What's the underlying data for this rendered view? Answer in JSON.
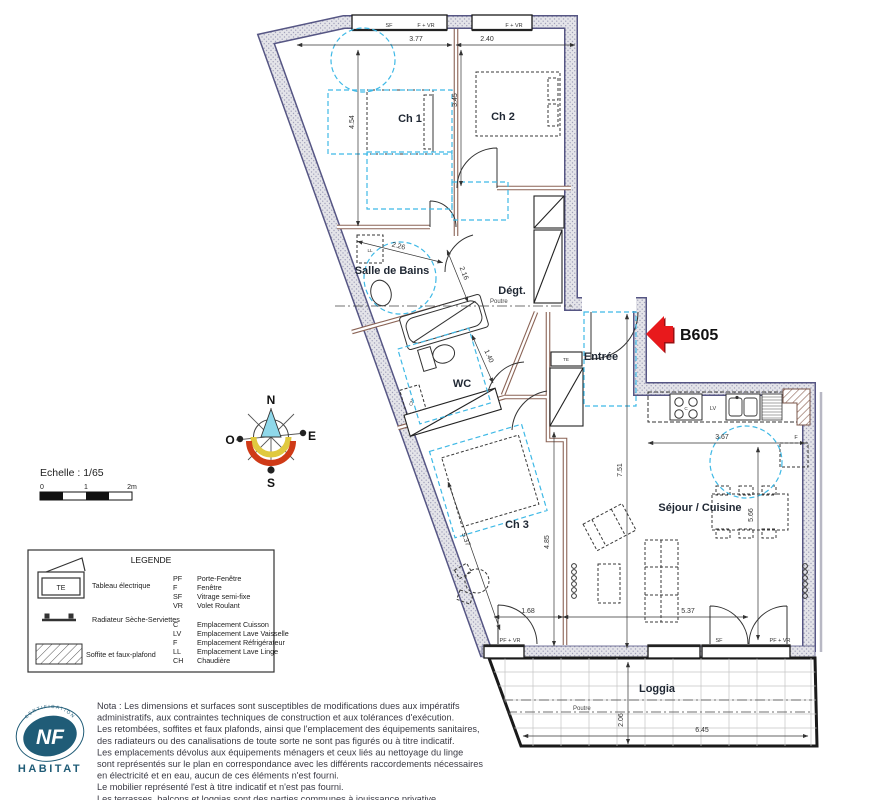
{
  "plan": {
    "unit_label": "B605",
    "rooms": {
      "ch1": "Ch 1",
      "ch2": "Ch 2",
      "ch3": "Ch 3",
      "sdb": "Salle de Bains",
      "degt": "Dégt.",
      "wc": "WC",
      "entree": "Entrée",
      "sejour": "Séjour / Cuisine",
      "loggia": "Loggia"
    },
    "dims": {
      "d377": "3.77",
      "d240": "2.40",
      "d454": "4.54",
      "d345": "3.45",
      "d226": "2.26",
      "d216": "2.16",
      "d140": "1.40",
      "d751": "7.51",
      "d367": "3.67",
      "d566": "5.66",
      "d485": "4.85",
      "d537": "5.37",
      "d168": "1.68",
      "d206": "2.06",
      "d645": "6.45"
    },
    "beam": "Poutre",
    "openings": {
      "sf": "SF",
      "fvr": "F + VR",
      "pfvr": "PF + VR"
    },
    "equipment": {
      "te": "TE",
      "ll": "LL",
      "ch": "CH",
      "lv": "LV",
      "c": "C",
      "f": "F"
    }
  },
  "compass": {
    "n": "N",
    "s": "S",
    "e": "E",
    "o": "O"
  },
  "scalebar": {
    "label": "Echelle : 1/65",
    "t0": "0",
    "t1": "1",
    "t2": "2m"
  },
  "legend": {
    "title": "LEGENDE",
    "sym_te": "Tableau électrique",
    "sym_rad": "Radiateur Sèche-Serviettes",
    "sym_soffite": "Soffite et faux-plafond",
    "codes_a": [
      {
        "c": "PF",
        "l": "Porte-Fenêtre"
      },
      {
        "c": "F",
        "l": "Fenêtre"
      },
      {
        "c": "SF",
        "l": "Vitrage semi-fixe"
      },
      {
        "c": "VR",
        "l": "Volet Roulant"
      }
    ],
    "codes_b": [
      {
        "c": "C",
        "l": "Emplacement Cuisson"
      },
      {
        "c": "LV",
        "l": "Emplacement  Lave Vaisselle"
      },
      {
        "c": "F",
        "l": "Emplacement  Réfrigérateur"
      },
      {
        "c": "LL",
        "l": "Emplacement Lave Linge"
      },
      {
        "c": "CH",
        "l": "Chaudière"
      }
    ]
  },
  "nota": {
    "lines": [
      "Nota : Les dimensions et surfaces sont susceptibles de modifications dues aux impératifs",
      "administratifs, aux contraintes techniques de construction et aux tolérances d'exécution.",
      "Les retombées, soffites et faux plafonds, ainsi que l'emplacement des équipements sanitaires,",
      "des radiateurs ou des canalisations de toute sorte ne sont pas figurés ou à titre indicatif.",
      "Les emplacements dévolus aux équipements ménagers et ceux liés au nettoyage du linge",
      "sont représentés sur le plan en correspondance avec les différents raccordements nécessaires",
      "en électricité et en eau, aucun de ces éléments n'est fourni.",
      "Le mobilier représenté l'est à titre indicatif et n'est pas fourni.",
      "Les terrasses, balcons et loggias sont des parties communes à jouissance privative."
    ]
  },
  "logo": {
    "nf": "NF",
    "habitat": "HABITAT",
    "ring": "CERTIFICATION"
  },
  "colors": {
    "accent_cyan": "#3fb9e6",
    "arrow_red": "#e8191c",
    "logo_blue": "#205c77",
    "wall_fill": "#e4e4e9",
    "wall_edge": "#565684",
    "inner_wall": "#8a6355"
  }
}
